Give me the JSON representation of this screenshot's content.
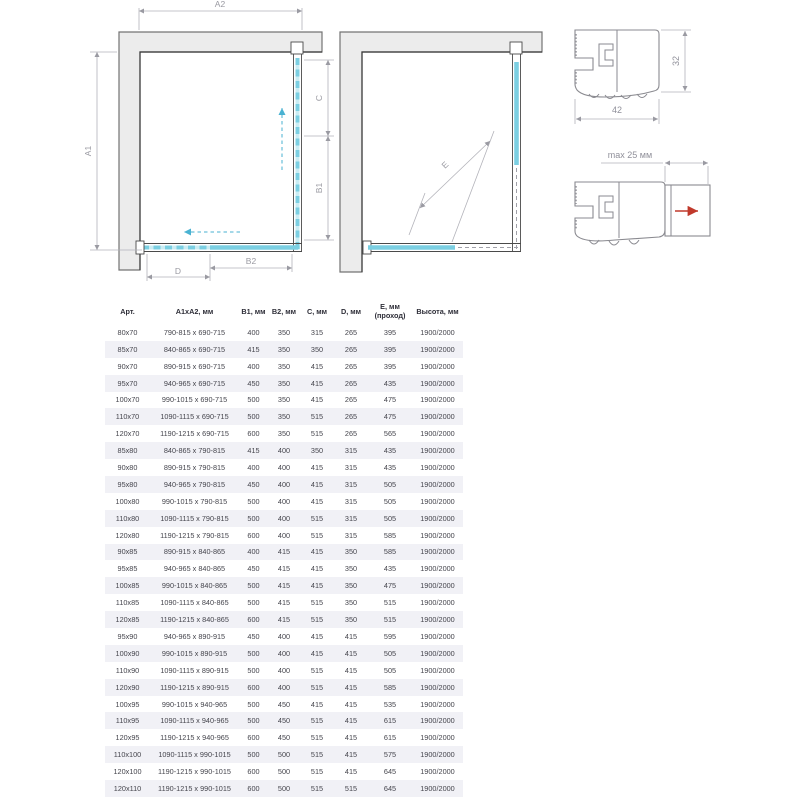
{
  "colors": {
    "glass_accent": "#7bcfe2",
    "wall_fill": "#ececec",
    "row_stripe": "#f1f1f6",
    "red_arrow": "#c0392b",
    "dimension_gray": "#9a9aa2"
  },
  "plan_closed": {
    "dim_a1": "A1",
    "dim_a2": "A2",
    "dim_b1": "B1",
    "dim_b2": "B2",
    "dim_c": "C",
    "dim_d": "D"
  },
  "plan_open": {
    "dim_e": "E"
  },
  "profile_main": {
    "dim_width": "42",
    "dim_height": "32"
  },
  "profile_adjust": {
    "dim_max": "max 25 мм"
  },
  "table": {
    "headers": [
      "Арт.",
      "A1xA2, мм",
      "B1, мм",
      "B2, мм",
      "C, мм",
      "D, мм",
      "E, мм\n(проход)",
      "Высота, мм"
    ],
    "rows": [
      [
        "80x70",
        "790-815 x 690-715",
        "400",
        "350",
        "315",
        "265",
        "395",
        "1900/2000"
      ],
      [
        "85x70",
        "840-865 x 690-715",
        "415",
        "350",
        "350",
        "265",
        "395",
        "1900/2000"
      ],
      [
        "90x70",
        "890-915 x 690-715",
        "400",
        "350",
        "415",
        "265",
        "395",
        "1900/2000"
      ],
      [
        "95x70",
        "940-965 x 690-715",
        "450",
        "350",
        "415",
        "265",
        "435",
        "1900/2000"
      ],
      [
        "100x70",
        "990-1015 x 690-715",
        "500",
        "350",
        "415",
        "265",
        "475",
        "1900/2000"
      ],
      [
        "110x70",
        "1090-1115 x 690-715",
        "500",
        "350",
        "515",
        "265",
        "475",
        "1900/2000"
      ],
      [
        "120x70",
        "1190-1215 x 690-715",
        "600",
        "350",
        "515",
        "265",
        "565",
        "1900/2000"
      ],
      [
        "85x80",
        "840-865 x 790-815",
        "415",
        "400",
        "350",
        "315",
        "435",
        "1900/2000"
      ],
      [
        "90x80",
        "890-915 x 790-815",
        "400",
        "400",
        "415",
        "315",
        "435",
        "1900/2000"
      ],
      [
        "95x80",
        "940-965 x 790-815",
        "450",
        "400",
        "415",
        "315",
        "505",
        "1900/2000"
      ],
      [
        "100x80",
        "990-1015 x 790-815",
        "500",
        "400",
        "415",
        "315",
        "505",
        "1900/2000"
      ],
      [
        "110x80",
        "1090-1115 x 790-815",
        "500",
        "400",
        "515",
        "315",
        "505",
        "1900/2000"
      ],
      [
        "120x80",
        "1190-1215 x 790-815",
        "600",
        "400",
        "515",
        "315",
        "585",
        "1900/2000"
      ],
      [
        "90x85",
        "890-915 x 840-865",
        "400",
        "415",
        "415",
        "350",
        "585",
        "1900/2000"
      ],
      [
        "95x85",
        "940-965 x 840-865",
        "450",
        "415",
        "415",
        "350",
        "435",
        "1900/2000"
      ],
      [
        "100x85",
        "990-1015 x 840-865",
        "500",
        "415",
        "415",
        "350",
        "475",
        "1900/2000"
      ],
      [
        "110x85",
        "1090-1115 x 840-865",
        "500",
        "415",
        "515",
        "350",
        "515",
        "1900/2000"
      ],
      [
        "120x85",
        "1190-1215 x 840-865",
        "600",
        "415",
        "515",
        "350",
        "515",
        "1900/2000"
      ],
      [
        "95x90",
        "940-965 x 890-915",
        "450",
        "400",
        "415",
        "415",
        "595",
        "1900/2000"
      ],
      [
        "100x90",
        "990-1015 x 890-915",
        "500",
        "400",
        "415",
        "415",
        "505",
        "1900/2000"
      ],
      [
        "110x90",
        "1090-1115 x 890-915",
        "500",
        "400",
        "515",
        "415",
        "505",
        "1900/2000"
      ],
      [
        "120x90",
        "1190-1215 x 890-915",
        "600",
        "400",
        "515",
        "415",
        "585",
        "1900/2000"
      ],
      [
        "100x95",
        "990-1015 x 940-965",
        "500",
        "450",
        "415",
        "415",
        "535",
        "1900/2000"
      ],
      [
        "110x95",
        "1090-1115 x 940-965",
        "500",
        "450",
        "515",
        "415",
        "615",
        "1900/2000"
      ],
      [
        "120x95",
        "1190-1215 x 940-965",
        "600",
        "450",
        "515",
        "415",
        "615",
        "1900/2000"
      ],
      [
        "110x100",
        "1090-1115 x 990-1015",
        "500",
        "500",
        "515",
        "415",
        "575",
        "1900/2000"
      ],
      [
        "120x100",
        "1190-1215 x 990-1015",
        "600",
        "500",
        "515",
        "415",
        "645",
        "1900/2000"
      ],
      [
        "120x110",
        "1190-1215 x 990-1015",
        "600",
        "500",
        "515",
        "515",
        "645",
        "1900/2000"
      ]
    ]
  }
}
